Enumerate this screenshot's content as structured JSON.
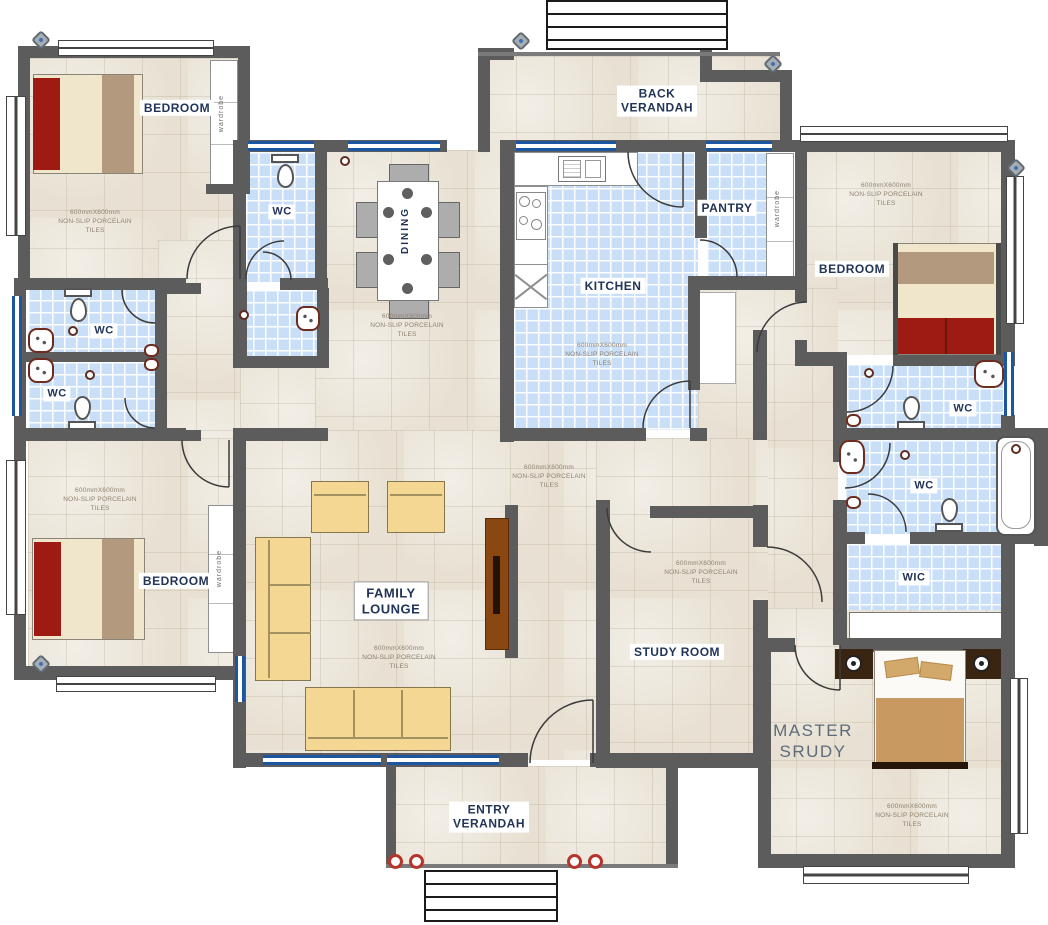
{
  "title": "House floor plan",
  "labels": {
    "bedroom": "BEDROOM",
    "wc": "WC",
    "wic": "WIC",
    "pantry": "PANTRY",
    "kitchen": "KITCHEN",
    "dining": "DINING",
    "study": "STUDY ROOM",
    "wardrobe": "wardrobe",
    "back_verandah_1": "BACK",
    "back_verandah_2": "VERANDAH",
    "entry_verandah_1": "ENTRY",
    "entry_verandah_2": "VERANDAH",
    "family_lounge_1": "FAMILY",
    "family_lounge_2": "LOUNGE",
    "master_1": "MASTER",
    "master_2": "SRUDY"
  },
  "tile_note": {
    "l1": "600mmX600mm",
    "l2": "NON-SLIP PORCELAIN",
    "l3": "TILES"
  },
  "colors": {
    "wall": "#5c5c5c",
    "floor_tile": "#e8e1d3",
    "wet_tile": "#c9dff7",
    "window_blue": "#1c55a0",
    "bed_red": "#9e1b13",
    "sofa_tan": "#f3d793",
    "wood_brown": "#8a4712",
    "label_text": "#223457",
    "master_label_text": "#5d6b7b",
    "column_red": "#b5342c"
  }
}
